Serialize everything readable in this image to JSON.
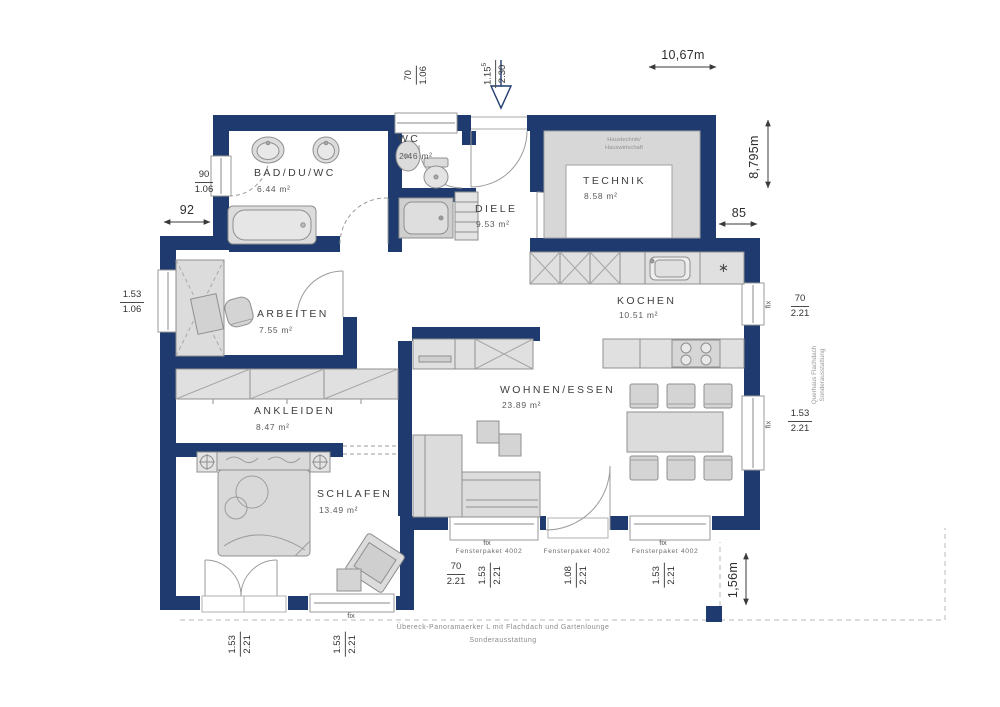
{
  "plan": {
    "rooms": [
      {
        "id": "bad",
        "name": "BAD/DU/WC",
        "area": "6.44 m²"
      },
      {
        "id": "wc",
        "name": "WC",
        "area": "2.46 m²"
      },
      {
        "id": "diele",
        "name": "DIELE",
        "area": "9.53 m²"
      },
      {
        "id": "technik",
        "name": "TECHNIK",
        "area": "8.58 m²"
      },
      {
        "id": "kochen",
        "name": "KOCHEN",
        "area": "10.51 m²"
      },
      {
        "id": "arbeiten",
        "name": "ARBEITEN",
        "area": "7.55 m²"
      },
      {
        "id": "ankleiden",
        "name": "ANKLEIDEN",
        "area": "8.47 m²"
      },
      {
        "id": "wohnen",
        "name": "WOHNEN/ESSEN",
        "area": "23.89 m²"
      },
      {
        "id": "schlafen",
        "name": "SCHLAFEN",
        "area": "13.49 m²"
      }
    ],
    "overall": {
      "width": "10,67m",
      "depth": "8,795m",
      "right_offset": "85",
      "left_offset": "92",
      "terrace_depth": "1,56m"
    },
    "openings": {
      "top_window": {
        "w": "70",
        "h": "1.06"
      },
      "entrance": {
        "w": "1.15",
        "sup": "5",
        "h": "2.30"
      },
      "bad_window": {
        "w": "90",
        "h": "1.06"
      },
      "arbeiten_window": {
        "w": "1.53",
        "h": "1.06"
      },
      "kochen_window": {
        "fix": "fix",
        "w": "70",
        "h": "2.21"
      },
      "essen_window": {
        "fix": "fix",
        "w": "1.53",
        "h": "2.21"
      }
    },
    "bottom_groups": [
      {
        "fix": "fix",
        "package": "Fensterpaket 4002",
        "dim_a": {
          "w": "70",
          "h": "2.21"
        },
        "dim_b": {
          "w": "1.53",
          "h": "2.21"
        }
      },
      {
        "package": "Fensterpaket 4002",
        "dim_b": {
          "w": "1.08",
          "h": "2.21"
        }
      },
      {
        "fix": "fix",
        "package": "Fensterpaket 4002",
        "dim_b": {
          "w": "1.53",
          "h": "2.21"
        }
      }
    ],
    "schlafen_groups": [
      {
        "dim_b": {
          "w": "1.53",
          "h": "2.21"
        }
      },
      {
        "fix": "fix",
        "dim_b": {
          "w": "1.53",
          "h": "2.21"
        }
      }
    ],
    "notes": {
      "technik_line1": "Haustechnik/",
      "technik_line2": "Hauswirtschaft",
      "right_line1": "Querhaus Flachdach",
      "right_line2": "Sonderausstattung",
      "bottom_line1": "Übereck-Panoramaerker L mit Flachdach und Gartenlounge",
      "bottom_line2": "Sonderausstattung"
    },
    "symbols": {
      "freezer": "∗"
    }
  },
  "colors": {
    "wall": "#1f3a6e",
    "furniture_fill": "#dcdcdc",
    "furniture_stroke": "#8f8f8f",
    "label": "#3e3e3e",
    "dimension": "#333333",
    "note": "#8a8a8a"
  }
}
